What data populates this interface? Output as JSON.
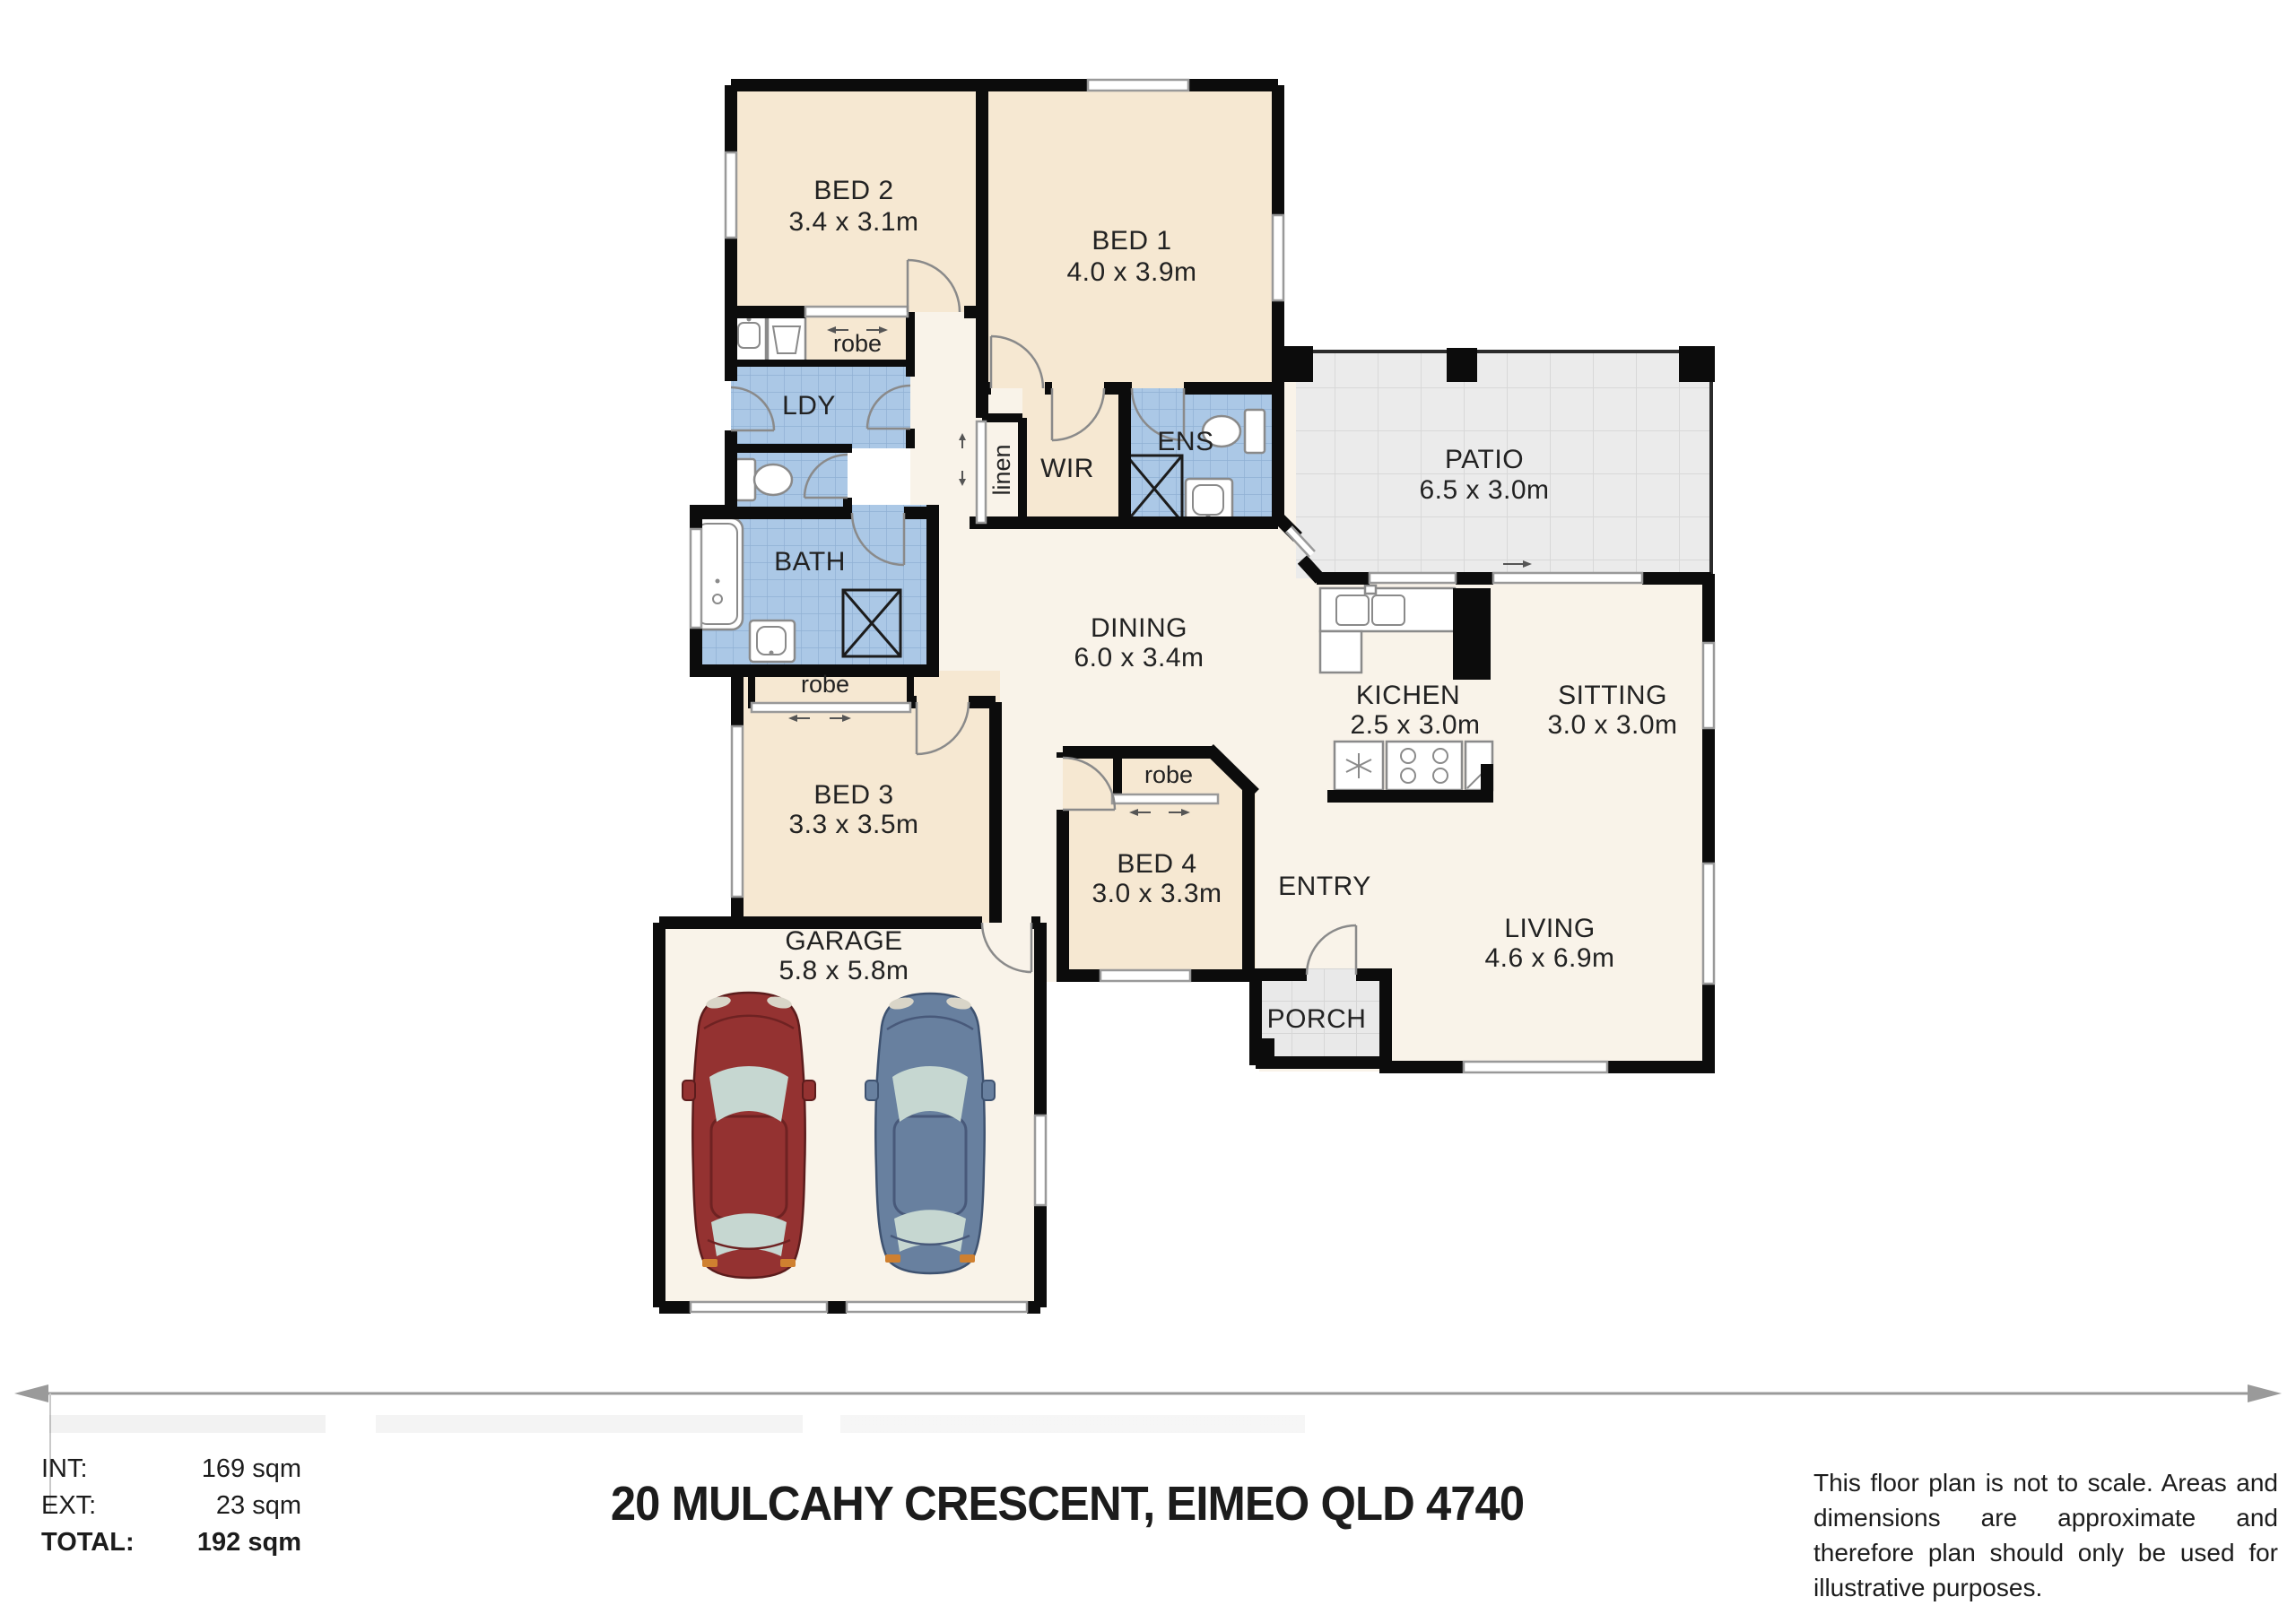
{
  "header": {
    "title": "20 MULCAHY CRESCENT, EIMEO QLD 4740"
  },
  "areas": {
    "int": {
      "label": "INT:",
      "value": "169 sqm"
    },
    "ext": {
      "label": "EXT:",
      "value": "23 sqm"
    },
    "total": {
      "label": "TOTAL:",
      "value": "192 sqm"
    }
  },
  "disclaimer": "This floor plan is not to scale. Areas and dimensions are approximate and therefore plan should only be used for illustrative purposes.",
  "rooms": {
    "bed1": {
      "name": "BED 1",
      "dims": "4.0 x 3.9m"
    },
    "bed2": {
      "name": "BED 2",
      "dims": "3.4 x 3.1m"
    },
    "bed3": {
      "name": "BED 3",
      "dims": "3.3 x 3.5m"
    },
    "bed4": {
      "name": "BED 4",
      "dims": "3.0 x 3.3m"
    },
    "patio": {
      "name": "PATIO",
      "dims": "6.5 x 3.0m"
    },
    "dining": {
      "name": "DINING",
      "dims": "6.0 x 3.4m"
    },
    "kitchen": {
      "name": "KICHEN",
      "dims": "2.5 x 3.0m"
    },
    "sitting": {
      "name": "SITTING",
      "dims": "3.0 x 3.0m"
    },
    "living": {
      "name": "LIVING",
      "dims": "4.6 x 6.9m"
    },
    "garage": {
      "name": "GARAGE",
      "dims": "5.8 x 5.8m"
    },
    "entry": {
      "name": "ENTRY"
    },
    "porch": {
      "name": "PORCH"
    },
    "laundry": {
      "name": "LDY"
    },
    "bath": {
      "name": "BATH"
    },
    "ensuite": {
      "name": "ENS"
    },
    "wir": {
      "name": "WIR"
    },
    "linen": {
      "name": "linen"
    },
    "robe": {
      "name": "robe"
    }
  },
  "colors": {
    "wall": "#0c0c0c",
    "room_peach": "#f6e8d2",
    "floor_cream": "#f9f3e9",
    "tile_blue": "#abc8e6",
    "tile_blue_grid": "#8fb0d4",
    "tile_gray": "#ebebeb",
    "tile_porch": "#e9e9e9",
    "car_red": "#943231",
    "car_blue": "#68809f",
    "car_glass": "#c6d7d1"
  }
}
